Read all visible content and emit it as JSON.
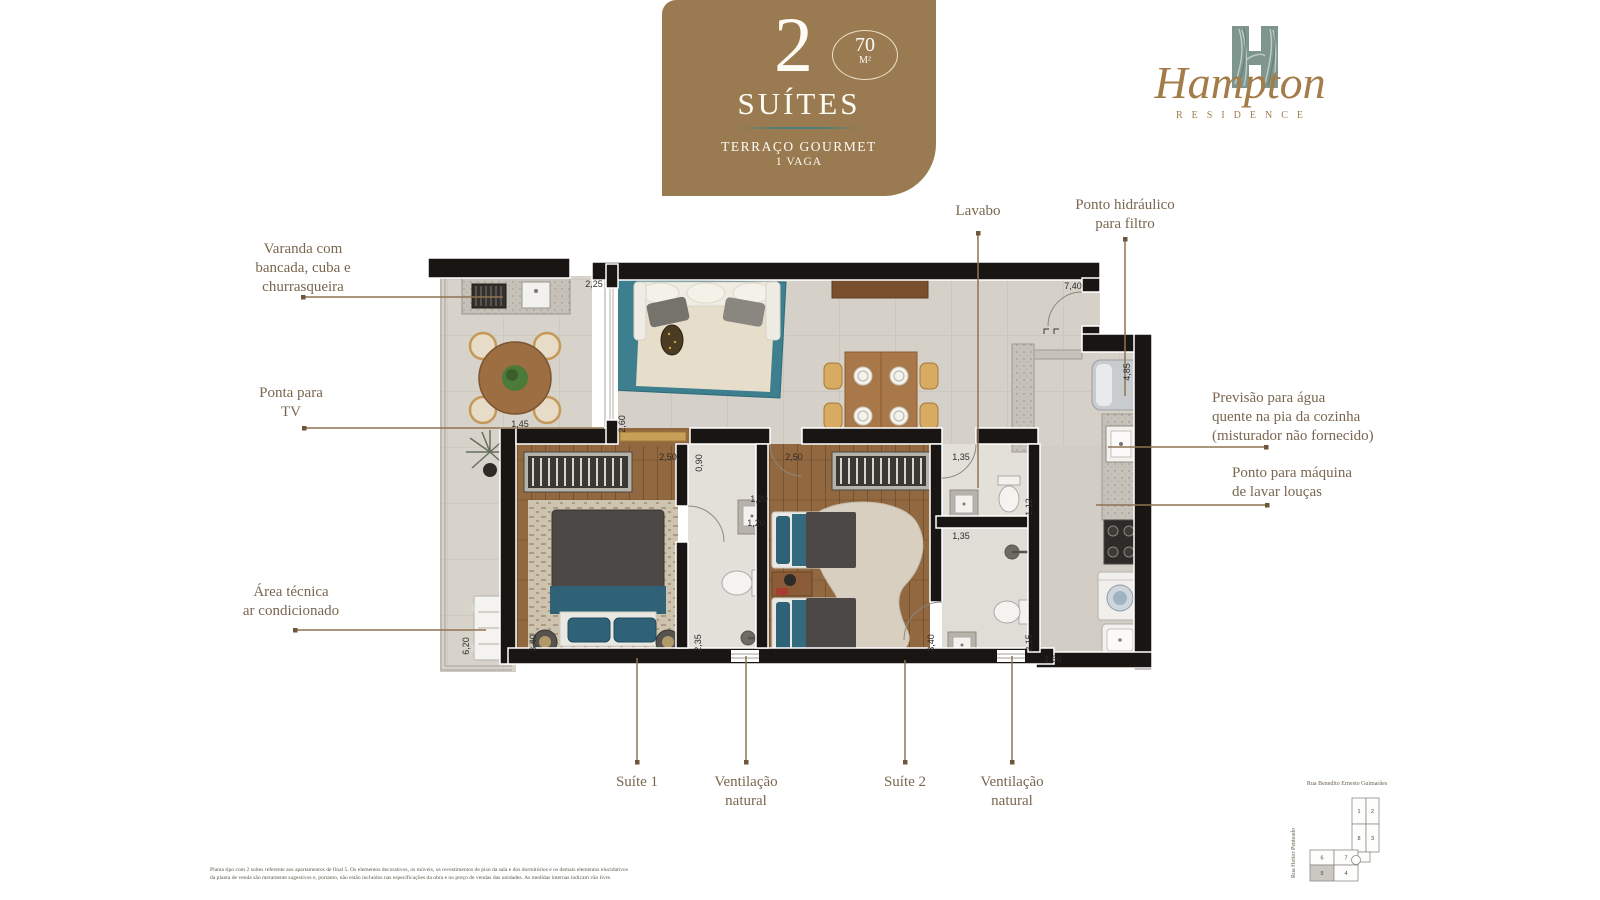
{
  "badge": {
    "number": "2",
    "type_label": "SUÍTES",
    "area_value": "70",
    "area_unit": "M²",
    "feature_line1": "TERRAÇO GOURMET",
    "feature_line2": "1 VAGA"
  },
  "logo": {
    "name": "Hampton",
    "subtitle": "RESIDENCE"
  },
  "callouts": {
    "varanda": {
      "lines": [
        "Varanda com",
        "bancada, cuba e",
        "churrasqueira"
      ]
    },
    "tv": {
      "lines": [
        "Ponta para",
        "TV"
      ]
    },
    "area_tecnica": {
      "lines": [
        "Área técnica",
        "ar condicionado"
      ]
    },
    "lavabo": {
      "lines": [
        "Lavabo"
      ]
    },
    "ponto_hidraulico": {
      "lines": [
        "Ponto hidráulico",
        "para filtro"
      ]
    },
    "previsao_agua": {
      "lines": [
        "Previsão para água",
        "quente na pia da cozinha",
        "(misturador não fornecido)"
      ]
    },
    "maquina_loucas": {
      "lines": [
        "Ponto para máquina",
        "de lavar louças"
      ]
    },
    "suite1": {
      "lines": [
        "Suíte 1"
      ]
    },
    "vent1": {
      "lines": [
        "Ventilação",
        "natural"
      ]
    },
    "suite2": {
      "lines": [
        "Suíte 2"
      ]
    },
    "vent2": {
      "lines": [
        "Ventilação",
        "natural"
      ]
    }
  },
  "dimensions": [
    {
      "text": "2,25",
      "x": 594,
      "y": 284,
      "rot": 0
    },
    {
      "text": "7,40",
      "x": 1073,
      "y": 286,
      "rot": 0
    },
    {
      "text": "4,85",
      "x": 1127,
      "y": 372,
      "rot": 90
    },
    {
      "text": "1,45",
      "x": 520,
      "y": 424,
      "rot": 0
    },
    {
      "text": "2,60",
      "x": 622,
      "y": 424,
      "rot": 90
    },
    {
      "text": "2,50",
      "x": 668,
      "y": 457,
      "rot": 0
    },
    {
      "text": "0,90",
      "x": 699,
      "y": 463,
      "rot": 90
    },
    {
      "text": "1,20",
      "x": 759,
      "y": 499,
      "rot": 0
    },
    {
      "text": "1,20",
      "x": 756,
      "y": 523,
      "rot": 0
    },
    {
      "text": "2,35",
      "x": 698,
      "y": 643,
      "rot": 90
    },
    {
      "text": "3,40",
      "x": 533,
      "y": 643,
      "rot": 90
    },
    {
      "text": "2,50",
      "x": 794,
      "y": 457,
      "rot": 0
    },
    {
      "text": "1,35",
      "x": 961,
      "y": 457,
      "rot": 0
    },
    {
      "text": "1,12",
      "x": 1029,
      "y": 507,
      "rot": 90
    },
    {
      "text": "1,35",
      "x": 961,
      "y": 536,
      "rot": 0
    },
    {
      "text": "2,15",
      "x": 1029,
      "y": 643,
      "rot": 90
    },
    {
      "text": "3,40",
      "x": 931,
      "y": 643,
      "rot": 90
    },
    {
      "text": "1,60",
      "x": 1053,
      "y": 659,
      "rot": 0
    },
    {
      "text": "6,20",
      "x": 466,
      "y": 646,
      "rot": 90
    }
  ],
  "minimap": {
    "street_top": "Rua Benedito Ernesto Guimarães",
    "street_left": "Rua Heitor Penteado",
    "units": [
      "1",
      "2",
      "8",
      "3",
      "6",
      "7",
      "5",
      "4"
    ],
    "highlighted_unit": "5"
  },
  "disclaimer": {
    "lines": [
      "Planta tipo com 2 suítes referente aos apartamentos de final 5. Os elementos decorativos, os móveis, os revestimentos de piso da sala e dos dormitórios e os demais elementos elucidativos",
      "da planta de venda são meramente sugestivos e, portanto, não estão incluídos nas especificações da obra e no preço de vendas das unidades. As medidas internas indicam vão livre."
    ]
  },
  "colors": {
    "badge_brown": "#9a7b51",
    "accent_teal": "#4e7e7c",
    "label_brown": "#7a6750",
    "logo_brown": "#a47c4a",
    "logo_green": "#7e968d",
    "leader_brown": "#8f7352"
  }
}
